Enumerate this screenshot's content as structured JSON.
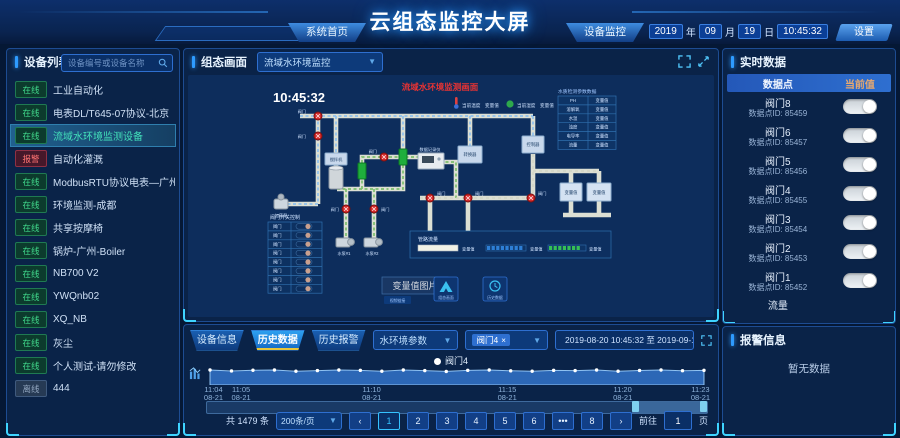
{
  "colors": {
    "accent": "#2e9bff",
    "alarm_red": "#e83333",
    "online_green": "#41d98c",
    "brand_blue": "#1668c4"
  },
  "header": {
    "title": "云组态监控大屏",
    "tab_home": "系统首页",
    "tab_monitor": "设备监控",
    "year": "2019",
    "year_unit": "年",
    "month": "09",
    "month_unit": "月",
    "day": "19",
    "day_unit": "日",
    "time": "10:45:32",
    "settings": "设置"
  },
  "sidebar": {
    "title": "设备列表",
    "search_placeholder": "设备编号或设备名称",
    "items": [
      {
        "status": "在线",
        "label": "工业自动化"
      },
      {
        "status": "在线",
        "label": "电表DL/T645-07协议-北京"
      },
      {
        "status": "在线",
        "label": "流域水环境监测设备"
      },
      {
        "status": "报警",
        "label": "自动化灌溉"
      },
      {
        "status": "在线",
        "label": "ModbusRTU协议电表—广州"
      },
      {
        "status": "在线",
        "label": "环境监测-成都"
      },
      {
        "status": "在线",
        "label": "共享按摩椅"
      },
      {
        "status": "在线",
        "label": "锅炉-广州-Boiler"
      },
      {
        "status": "在线",
        "label": "NB700 V2"
      },
      {
        "status": "在线",
        "label": "YWQnb02"
      },
      {
        "status": "在线",
        "label": "XQ_NB"
      },
      {
        "status": "在线",
        "label": "灰尘"
      },
      {
        "status": "在线",
        "label": "个人测试-请勿修改"
      },
      {
        "status": "离线",
        "label": "444"
      }
    ]
  },
  "scada": {
    "panel_title": "组态画面",
    "screen_select": "流域水环境监控",
    "diagram_title": "流域水环境监测画面",
    "clock": "10:45:32",
    "env": {
      "temp_label": "当前温度",
      "temp_value": "变量值",
      "hum_label": "当前湿度",
      "hum_value": "变量值"
    },
    "water_table": {
      "title": "水质检测参数数据",
      "rows": [
        [
          "PH",
          "变量值"
        ],
        [
          "溶解氧",
          "变量值"
        ],
        [
          "水温",
          "变量值"
        ],
        [
          "浊度",
          "变量值"
        ],
        [
          "电导率",
          "变量值"
        ],
        [
          "流量",
          "变量值"
        ]
      ]
    },
    "valve_panel": {
      "title": "阀门开关控制",
      "row_label": "阀门"
    },
    "flow_panel": {
      "title": "管路流量",
      "bar_labels": [
        "变量值",
        "变量值",
        "变量值"
      ]
    },
    "labels": {
      "mixer": "搅拌机",
      "dosing": "加药泵",
      "recorder": "数据记录仪",
      "converter": "转换器",
      "controller": "控制器",
      "pump1": "水泵#1",
      "pump2": "水泵#2",
      "valve": "阀门",
      "box1": "变量值",
      "box2": "变量值"
    },
    "footer": {
      "image_text": "变量值图片",
      "chip1": "视频链接",
      "chip2": "组态画面",
      "chip3": "历史数据"
    }
  },
  "history": {
    "tabs": [
      "设备信息",
      "历史数据",
      "历史报警"
    ],
    "param_select": "水环境参数",
    "point_tag": "阀门4",
    "tag_close": "×",
    "date_range": "2019-08-20 10:45:32 至 2019-09-19 10:45:32",
    "legend": "阀门4",
    "total_text": "共 1479 条",
    "page_size": "200条/页",
    "pager": {
      "prev": "‹",
      "pages": [
        "1",
        "2",
        "3",
        "4",
        "5",
        "6",
        "•••",
        "8"
      ],
      "next": "›",
      "goto_label": "前往",
      "goto_value": "1",
      "goto_unit": "页"
    }
  },
  "chart_data": {
    "type": "area",
    "title": "",
    "legend": "阀门4",
    "x_ticks": [
      {
        "time": "11:04",
        "date": "08-21"
      },
      {
        "time": "11:05",
        "date": "08-21"
      },
      {
        "time": "11:10",
        "date": "08-21"
      },
      {
        "time": "11:15",
        "date": "08-21"
      },
      {
        "time": "11:20",
        "date": "08-21"
      },
      {
        "time": "11:23",
        "date": "08-21"
      }
    ],
    "ylim": [
      0,
      1
    ],
    "series": [
      {
        "name": "阀门4",
        "values": [
          1,
          0.92,
          0.98,
          1,
          0.9,
          0.95,
          1,
          0.97,
          0.9,
          1,
          0.95,
          0.88,
          0.97,
          1,
          0.93,
          0.9,
          0.97,
          0.95,
          1,
          0.9,
          0.96,
          1,
          0.94,
          0.97
        ]
      }
    ],
    "brush_selection": [
      0.85,
      1.0
    ]
  },
  "realtime": {
    "title": "实时数据",
    "col_point": "数据点",
    "col_value": "当前值",
    "rows": [
      {
        "name": "阀门8",
        "id": "数据点ID: 85459",
        "on": true
      },
      {
        "name": "阀门6",
        "id": "数据点ID: 85457",
        "on": true
      },
      {
        "name": "阀门5",
        "id": "数据点ID: 85456",
        "on": true
      },
      {
        "name": "阀门4",
        "id": "数据点ID: 85455",
        "on": true
      },
      {
        "name": "阀门3",
        "id": "数据点ID: 85454",
        "on": true
      },
      {
        "name": "阀门2",
        "id": "数据点ID: 85453",
        "on": true
      },
      {
        "name": "阀门1",
        "id": "数据点ID: 85452",
        "on": true
      }
    ],
    "partial_row": "流量"
  },
  "alarm": {
    "title": "报警信息",
    "empty": "暂无数据"
  }
}
